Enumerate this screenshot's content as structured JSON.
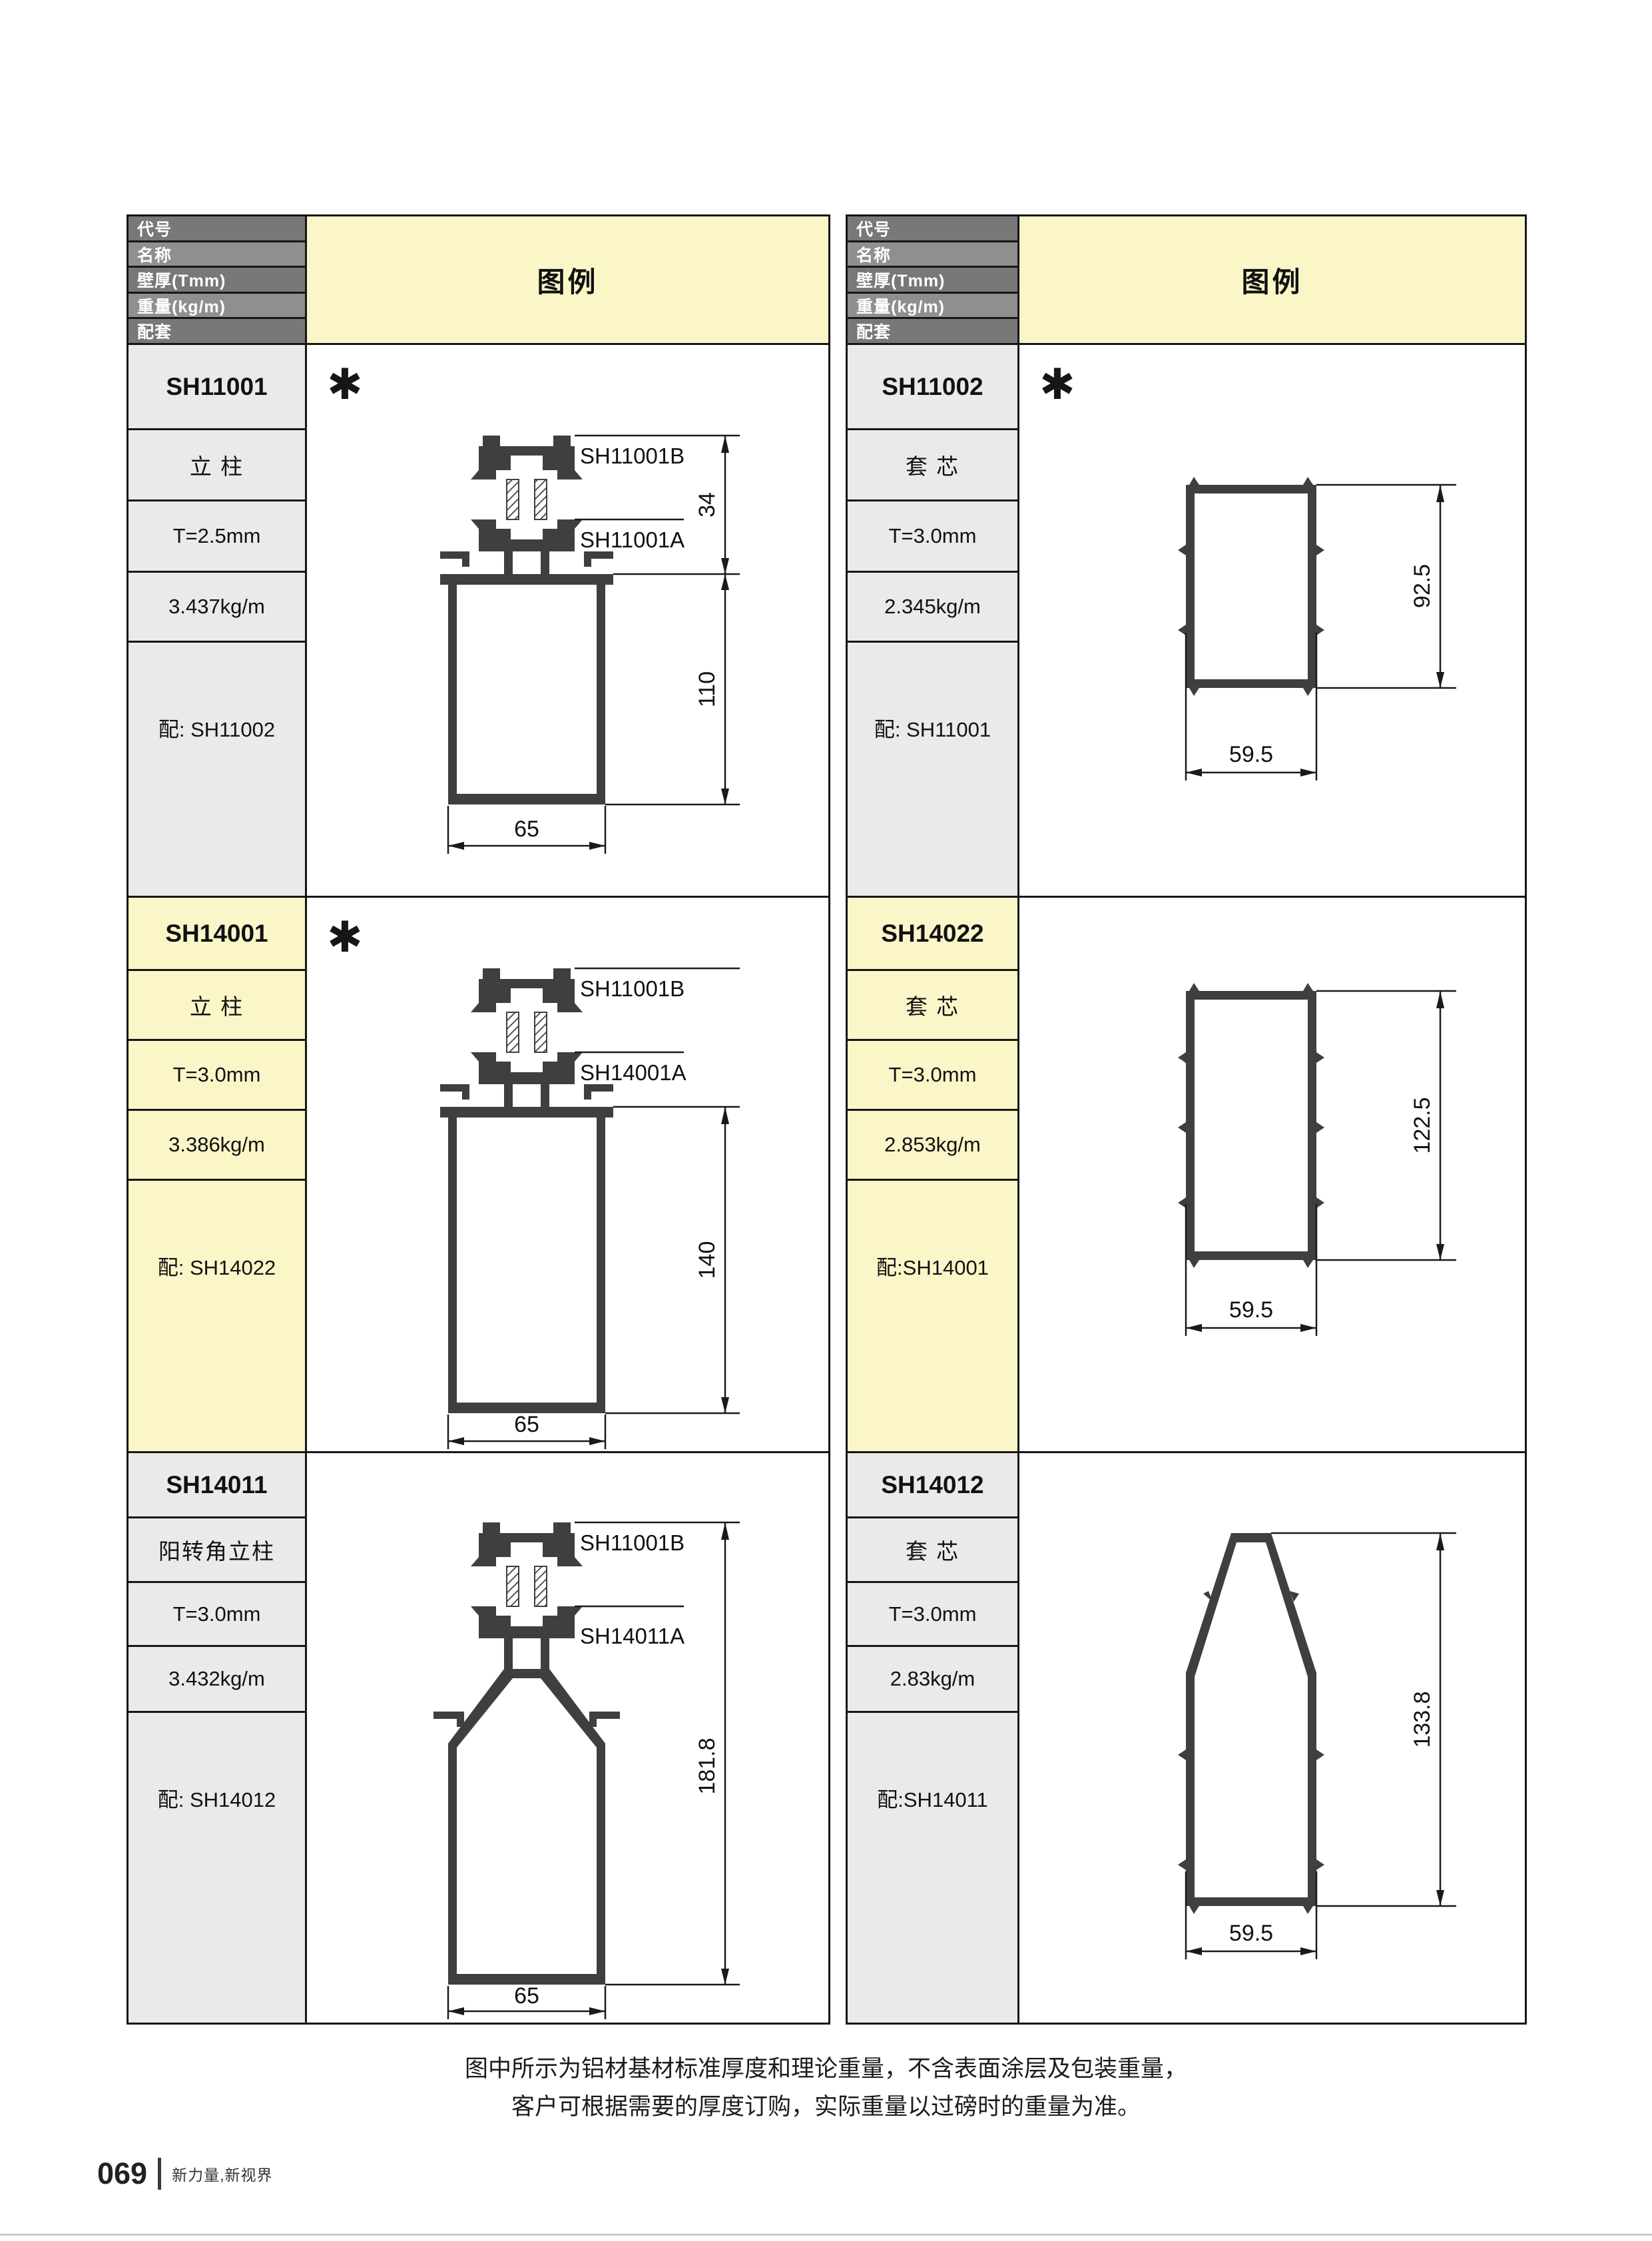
{
  "symbols": {
    "asterisk": "✱"
  },
  "colors": {
    "legend_yellow": "#faf6c8",
    "header_gray_dark": "#787878",
    "header_gray_light": "#8f8f8f",
    "row_gray": "#eaeaea",
    "row_yellow": "#faf6c8",
    "profile_fill": "#3f3f3f",
    "line_black": "#1a1a1a"
  },
  "tables": [
    {
      "header": {
        "col_labels": [
          "代号",
          "名称",
          "壁厚(Tmm)",
          "重量(kg/m)",
          "配套"
        ],
        "legend": "图例"
      },
      "rows": [
        {
          "code": "SH11001",
          "name": "立 柱",
          "thickness": "T=2.5mm",
          "weight": "3.437kg/m",
          "pair": "配: SH11002",
          "diagram": {
            "top_part": "SH11001B",
            "bottom_part": "SH11001A",
            "connector_height": "34",
            "height": "110",
            "width": "65"
          }
        },
        {
          "code": "SH14001",
          "name": "立 柱",
          "thickness": "T=3.0mm",
          "weight": "3.386kg/m",
          "pair": "配: SH14022",
          "diagram": {
            "top_part": "SH11001B",
            "bottom_part": "SH14001A",
            "height": "140",
            "width": "65"
          }
        },
        {
          "code": "SH14011",
          "name": "阳转角立柱",
          "thickness": "T=3.0mm",
          "weight": "3.432kg/m",
          "pair": "配: SH14012",
          "diagram": {
            "top_part": "SH11001B",
            "bottom_part": "SH14011A",
            "height": "181.8",
            "width": "65"
          }
        }
      ]
    },
    {
      "header": {
        "col_labels": [
          "代号",
          "名称",
          "壁厚(Tmm)",
          "重量(kg/m)",
          "配套"
        ],
        "legend": "图例"
      },
      "rows": [
        {
          "code": "SH11002",
          "name": "套 芯",
          "thickness": "T=3.0mm",
          "weight": "2.345kg/m",
          "pair": "配: SH11001",
          "diagram": {
            "height": "92.5",
            "width": "59.5"
          }
        },
        {
          "code": "SH14022",
          "name": "套 芯",
          "thickness": "T=3.0mm",
          "weight": "2.853kg/m",
          "pair": "配:SH14001",
          "diagram": {
            "height": "122.5",
            "width": "59.5"
          }
        },
        {
          "code": "SH14012",
          "name": "套 芯",
          "thickness": "T=3.0mm",
          "weight": "2.83kg/m",
          "pair": "配:SH14011",
          "diagram": {
            "height": "133.8",
            "width": "59.5"
          }
        }
      ]
    }
  ],
  "notes": [
    "图中所示为铝材基材标准厚度和理论重量，不含表面涂层及包装重量，",
    "客户可根据需要的厚度订购，实际重量以过磅时的重量为准。"
  ],
  "footer": {
    "page_number": "069",
    "slogan": "新力量,新视界"
  }
}
